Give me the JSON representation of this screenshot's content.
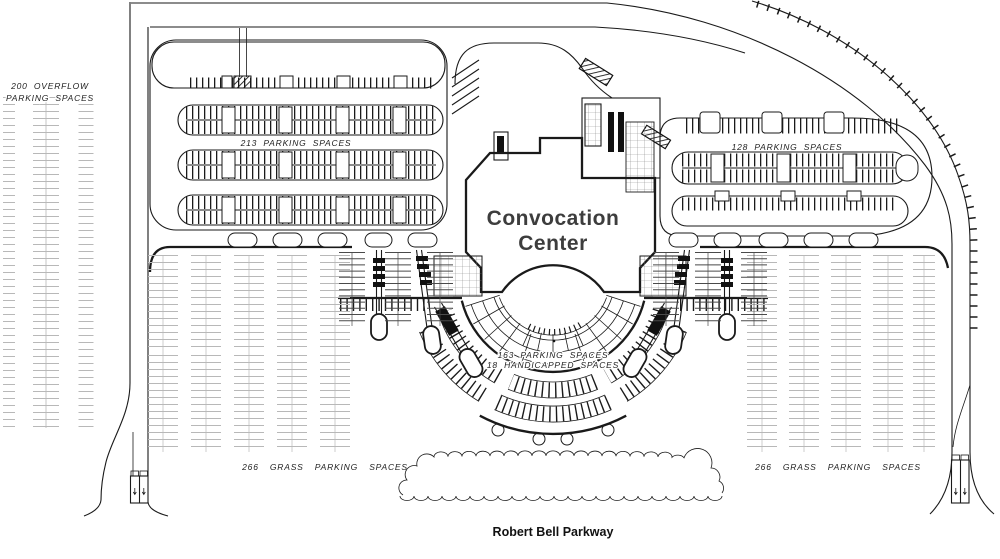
{
  "labels": {
    "overflow_line1": "200 OVERFLOW",
    "overflow_line2": "PARKING SPACES",
    "lot_nw": "213 PARKING SPACES",
    "lot_ne": "128 PARKING SPACES",
    "building_line1": "Convocation",
    "building_line2": "Center",
    "fan_line1": "163 PARKING SPACES",
    "fan_line2": "18 HANDICAPPED SPACES",
    "grass_sw": "266 GRASS PARKING SPACES",
    "grass_se": "266 GRASS PARKING SPACES",
    "parkway": "Robert Bell Parkway"
  },
  "counts": {
    "overflow_spaces": 200,
    "northwest_lot_spaces": 213,
    "northeast_lot_spaces": 128,
    "fan_lot_spaces": 163,
    "handicapped_spaces": 18,
    "grass_spaces_each_side": 266
  },
  "colors": {
    "ink": "#1a1a1a",
    "light_gray_parking": "#b8b8b8",
    "building_text": "#3d3d3d",
    "paper": "#ffffff"
  }
}
